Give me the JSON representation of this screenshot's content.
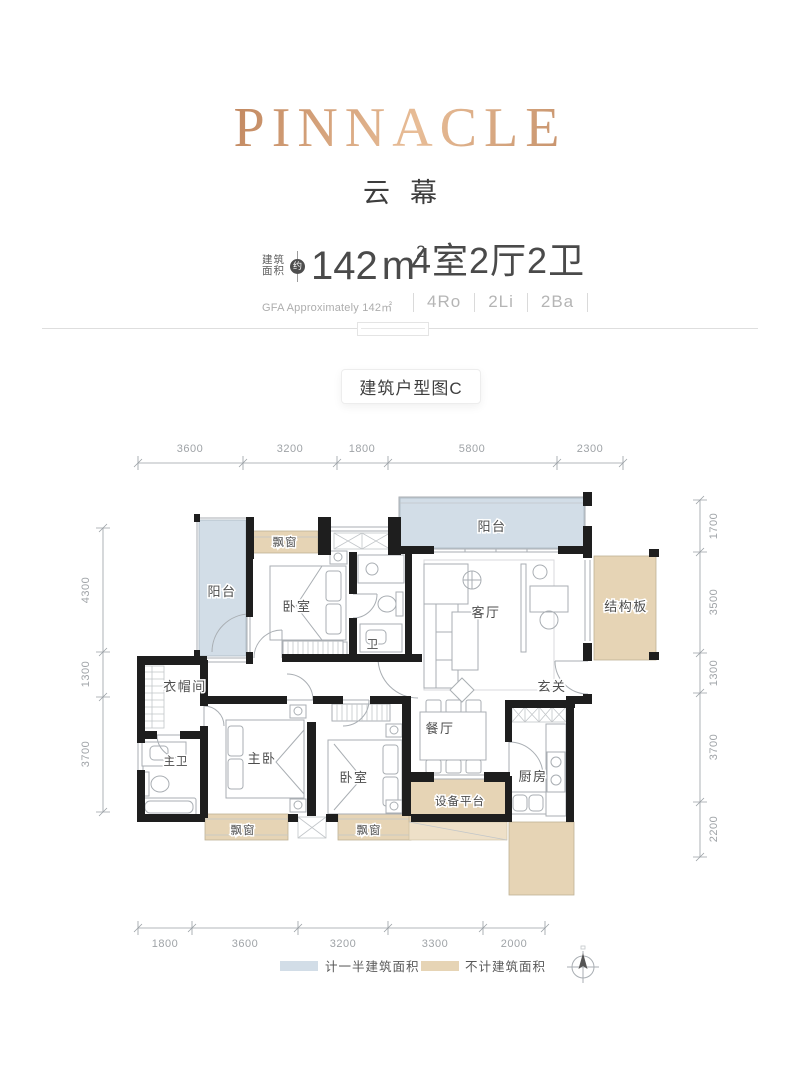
{
  "header": {
    "brand": "PINNACLE",
    "project_name": "云幕",
    "area_label_line1": "建筑",
    "area_label_line2": "面积",
    "approx_badge": "约",
    "area_value": "142",
    "area_unit": "m",
    "area_unit_sup": "2",
    "gfa_note": "GFA Approximately 142㎡",
    "layout_cn": "4室2厅2卫",
    "layout_en": [
      "4Ro",
      "2Li",
      "2Ba"
    ]
  },
  "plan_tab": {
    "label": "建筑户型图C"
  },
  "floorplan": {
    "rooms": {
      "balcony": "阳台",
      "bay_window": "飘窗",
      "bedroom": "卧室",
      "bath": "卫",
      "living": "客厅",
      "structure_panel": "结构板",
      "cloakroom": "衣帽间",
      "foyer": "玄关",
      "master_bath": "主卫",
      "master_bedroom": "主卧",
      "dining": "餐厅",
      "kitchen": "厨房",
      "equipment_platform": "设备平台"
    },
    "dimensions": {
      "top": [
        "3600",
        "3200",
        "1800",
        "5800",
        "2300"
      ],
      "bottom": [
        "1800",
        "3600",
        "3200",
        "3300",
        "2000"
      ],
      "left": [
        "4300",
        "1300",
        "3700"
      ],
      "right": [
        "1700",
        "3500",
        "1300",
        "3700",
        "2200"
      ]
    }
  },
  "legend": {
    "half_area": {
      "label": "计一半建筑面积",
      "color": "#d2dde7"
    },
    "excluded_area": {
      "label": "不计建筑面积",
      "color": "#e6d4b5"
    }
  },
  "colors": {
    "accent_copper": "#c08a63",
    "wall": "#1e1e1e",
    "text_dark": "#4a4a4a",
    "text_gray": "#a5a5a5"
  }
}
